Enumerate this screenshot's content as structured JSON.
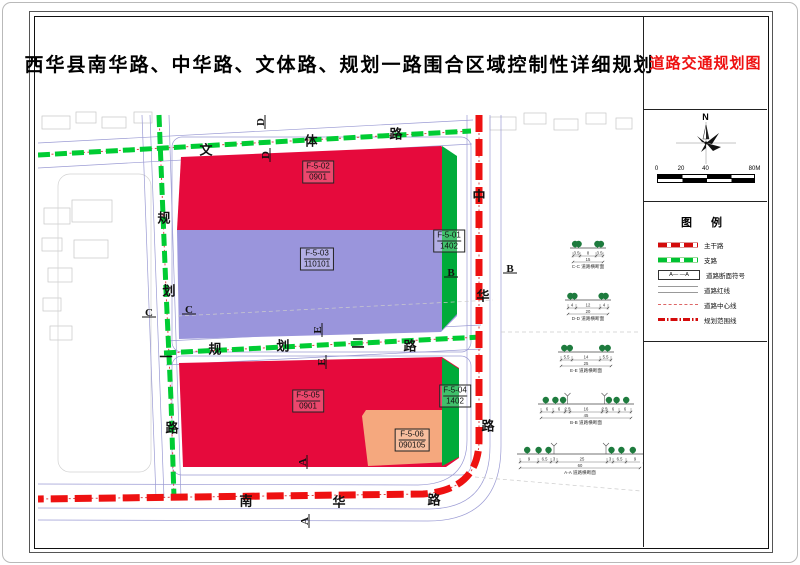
{
  "title": "西华县南华路、中华路、文体路、规划一路围合区域控制性详细规划",
  "panel": {
    "drawing_title": "道路交通规划图",
    "north_label": "N",
    "scale_ticks": [
      "0",
      "20",
      "40",
      "80M"
    ],
    "legend_title": "图  例",
    "legend": [
      {
        "key": "arterial",
        "label": "主干路"
      },
      {
        "key": "branch",
        "label": "支路"
      },
      {
        "key": "section",
        "label": "道路断面符号",
        "symbol_text": "A—  —A"
      },
      {
        "key": "redline",
        "label": "道路红线"
      },
      {
        "key": "centerline",
        "label": "道路中心线"
      },
      {
        "key": "boundary",
        "label": "规划范围线"
      }
    ]
  },
  "map": {
    "road_labels": [
      {
        "name": "文体路",
        "chars": [
          {
            "t": "文",
            "x": 168,
            "y": 40
          },
          {
            "t": "体",
            "x": 273,
            "y": 31
          },
          {
            "t": "路",
            "x": 358,
            "y": 24
          }
        ]
      },
      {
        "name": "规划一路",
        "chars": [
          {
            "t": "规",
            "x": 126,
            "y": 108
          },
          {
            "t": "划",
            "x": 131,
            "y": 181
          },
          {
            "t": "一",
            "x": 128,
            "y": 247
          },
          {
            "t": "路",
            "x": 134,
            "y": 318
          }
        ]
      },
      {
        "name": "规划二路",
        "chars": [
          {
            "t": "规",
            "x": 177,
            "y": 239
          },
          {
            "t": "划",
            "x": 245,
            "y": 236
          },
          {
            "t": "二",
            "x": 320,
            "y": 233
          },
          {
            "t": "路",
            "x": 372,
            "y": 236
          }
        ]
      },
      {
        "name": "中华路",
        "chars": [
          {
            "t": "中",
            "x": 441,
            "y": 86
          },
          {
            "t": "华",
            "x": 445,
            "y": 186
          },
          {
            "t": "路",
            "x": 450,
            "y": 316
          }
        ]
      },
      {
        "name": "南华路",
        "chars": [
          {
            "t": "南",
            "x": 208,
            "y": 391
          },
          {
            "t": "华",
            "x": 301,
            "y": 392
          },
          {
            "t": "路",
            "x": 396,
            "y": 390
          }
        ]
      }
    ],
    "parcels": [
      {
        "code": "F-5-02",
        "use": "0901",
        "x": 280,
        "y": 62
      },
      {
        "code": "F-5-03",
        "use": "110101",
        "x": 279,
        "y": 149
      },
      {
        "code": "F-5-01",
        "use": "1402",
        "x": 411,
        "y": 131
      },
      {
        "code": "F-5-05",
        "use": "0901",
        "x": 270,
        "y": 291
      },
      {
        "code": "F-5-06",
        "use": "090105",
        "x": 374,
        "y": 330
      },
      {
        "code": "F-5-04",
        "use": "1402",
        "x": 417,
        "y": 286
      }
    ],
    "section_markers": [
      {
        "letter": "D",
        "x": 223,
        "y": 12,
        "rot": -90
      },
      {
        "letter": "D",
        "x": 228,
        "y": 45,
        "rot": -90
      },
      {
        "letter": "C",
        "x": 111,
        "y": 203,
        "rot": 0
      },
      {
        "letter": "C",
        "x": 151,
        "y": 200,
        "rot": 0
      },
      {
        "letter": "E",
        "x": 280,
        "y": 220,
        "rot": -90
      },
      {
        "letter": "E",
        "x": 284,
        "y": 252,
        "rot": -90
      },
      {
        "letter": "B",
        "x": 413,
        "y": 163,
        "rot": 0
      },
      {
        "letter": "B",
        "x": 472,
        "y": 159,
        "rot": 0
      },
      {
        "letter": "A",
        "x": 265,
        "y": 352,
        "rot": -90
      },
      {
        "letter": "A",
        "x": 267,
        "y": 411,
        "rot": -90
      }
    ],
    "cross_sections": [
      {
        "caption": "C-C 道路横断面",
        "dims": [
          3.5,
          8,
          3.5
        ],
        "total": 15,
        "cx": 550,
        "y": 146,
        "lamps": false
      },
      {
        "caption": "D-D 道路横断面",
        "dims": [
          4,
          12,
          4
        ],
        "total": 20,
        "cx": 550,
        "y": 198,
        "lamps": false
      },
      {
        "caption": "E-E 道路横断面",
        "dims": [
          5.5,
          14,
          5.5
        ],
        "total": 25,
        "cx": 548,
        "y": 250,
        "lamps": false
      },
      {
        "caption": "B-B 道路横断面",
        "dims": [
          6,
          6,
          2.5,
          16,
          2.5,
          6,
          6
        ],
        "total": 45,
        "cx": 548,
        "y": 302,
        "lamps": true
      },
      {
        "caption": "A-A 道路横断面",
        "dims": [
          9,
          6.5,
          3,
          25,
          3,
          6.5,
          9
        ],
        "total": 60,
        "cx": 542,
        "y": 352,
        "lamps": true
      }
    ]
  },
  "colors": {
    "residential_red": "#e60a3c",
    "education_purple": "#9a95dc",
    "greenbelt_green": "#00ab3a",
    "commercial_salmon": "#f5a87e",
    "arterial_road_red": "#ee1111",
    "branch_road_green": "#00cc33",
    "centerline_red": "#dd4444",
    "drawing_title_red": "#ee1111",
    "tree_green": "#1e7b3e"
  }
}
